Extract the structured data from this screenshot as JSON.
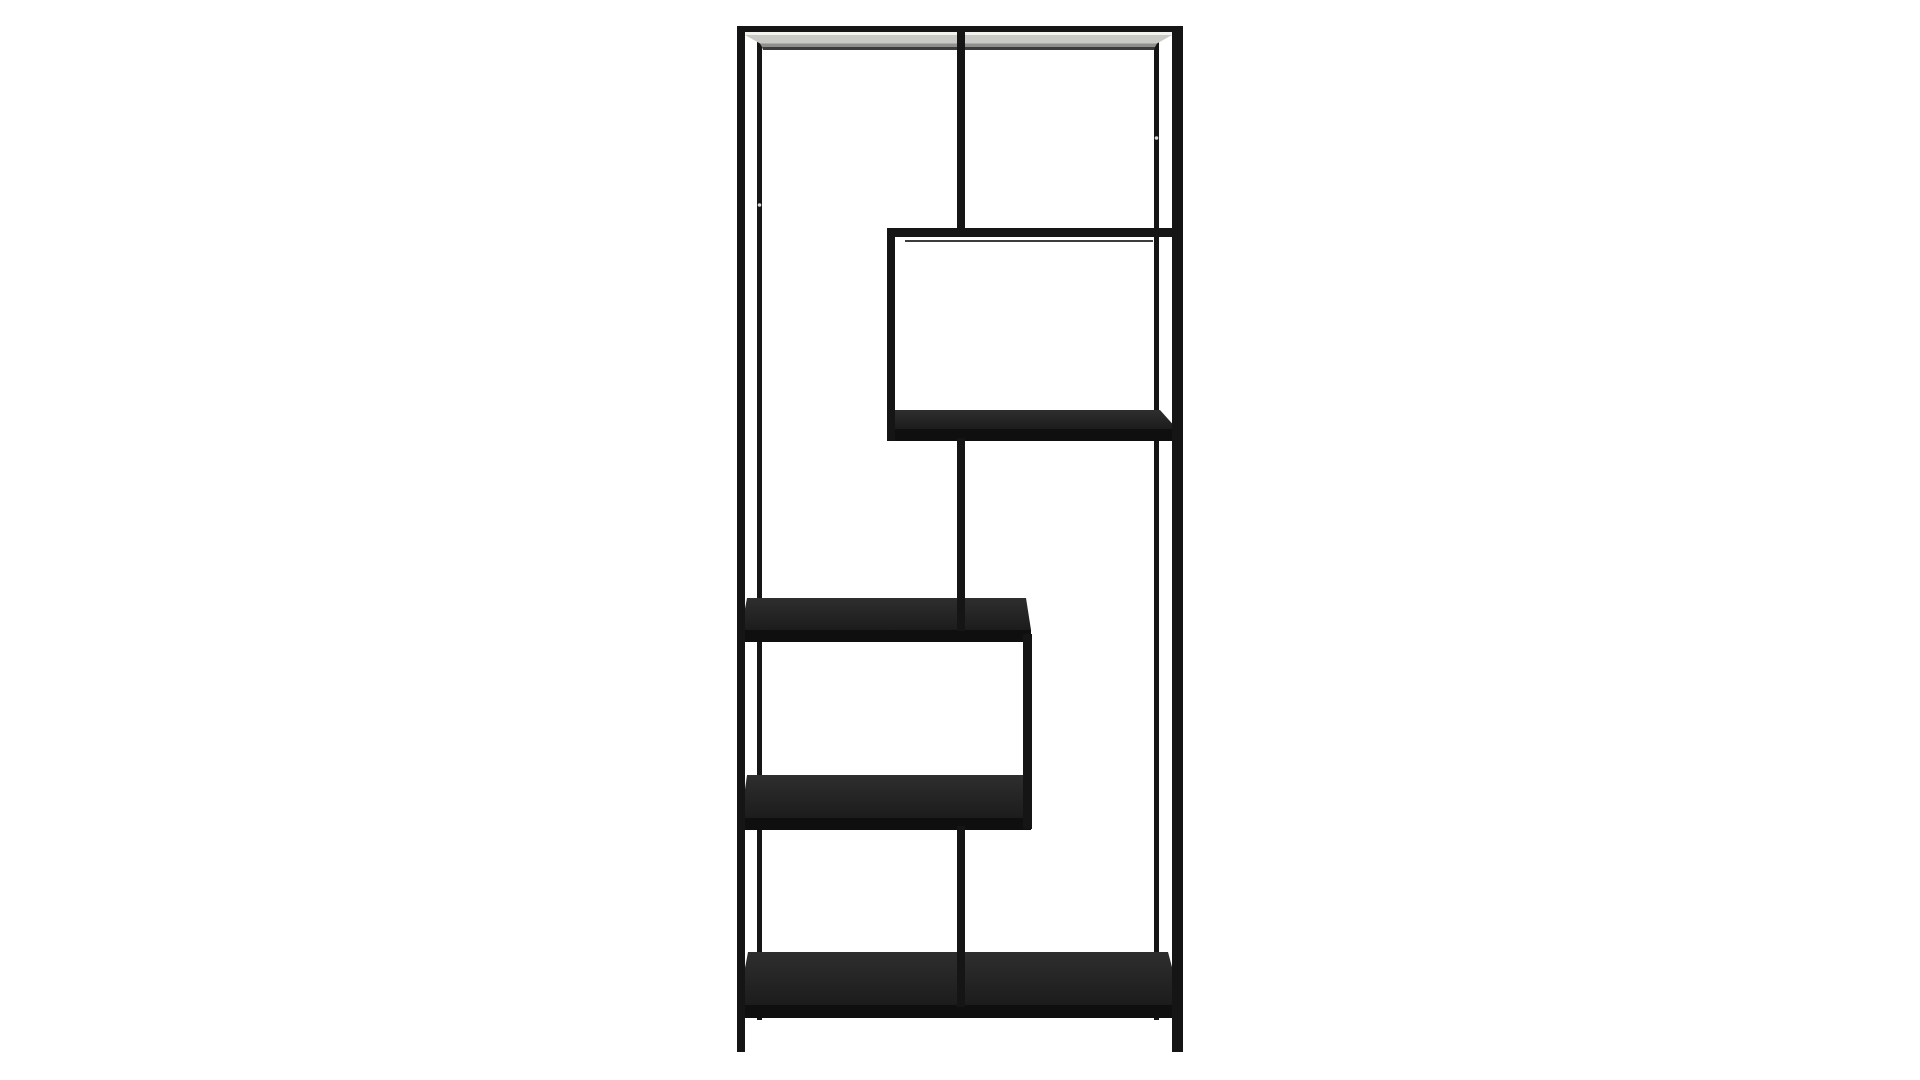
{
  "scene": {
    "type": "product-photo",
    "subject": "asymmetric-black-metal-bookcase",
    "description": "Tall rectangular black metal shelving unit with staggered black wood shelves on a plain white background",
    "background_color": "#ffffff"
  },
  "colors": {
    "metal": "#151515",
    "metal_faint": "#3c3c3c",
    "wood_top": "#1c1c1c",
    "wood_top_light": "#2e2e2e",
    "wood_front": "#0f0f0f",
    "top_shelf_highlight": "#f2f2ef",
    "top_shelf_light": "#c9c9c6",
    "top_shelf_shade": "#8f8f8d",
    "screw_dot": "#d9d9d9",
    "background": "#ffffff"
  },
  "geometry": {
    "viewbox": "0 0 1920 1080",
    "metal_bars": [
      {
        "name": "back-left-leg",
        "layer": "back",
        "x": 757,
        "y": 40,
        "w": 5,
        "h": 980
      },
      {
        "name": "back-right-leg",
        "layer": "back",
        "x": 1154,
        "y": 40,
        "w": 5,
        "h": 980
      },
      {
        "name": "top-rail",
        "layer": "front",
        "x": 737,
        "y": 26,
        "w": 446,
        "h": 6
      },
      {
        "name": "center-divider-upper",
        "layer": "front",
        "x": 957,
        "y": 31,
        "w": 8,
        "h": 201
      },
      {
        "name": "upper-right-shelf-rail",
        "layer": "front",
        "x": 887,
        "y": 228,
        "w": 290,
        "h": 9
      },
      {
        "name": "upper-right-shelf-back-edge",
        "layer": "front",
        "x": 905,
        "y": 240,
        "w": 248,
        "h": 2,
        "color": "metal_faint"
      },
      {
        "name": "upper-box-left-post",
        "layer": "front",
        "x": 887,
        "y": 228,
        "w": 8,
        "h": 213
      },
      {
        "name": "center-divider-middle",
        "layer": "front",
        "x": 957,
        "y": 438,
        "w": 8,
        "h": 193
      },
      {
        "name": "lower-box-right-post",
        "layer": "front",
        "x": 1023,
        "y": 634,
        "w": 9,
        "h": 195
      },
      {
        "name": "center-divider-lower",
        "layer": "front",
        "x": 957,
        "y": 826,
        "w": 8,
        "h": 181
      },
      {
        "name": "front-left-leg",
        "layer": "front",
        "x": 737,
        "y": 26,
        "w": 8,
        "h": 1026
      },
      {
        "name": "front-right-leg",
        "layer": "front",
        "x": 1172,
        "y": 26,
        "w": 11,
        "h": 1026
      }
    ],
    "top_shelf_strips": [
      {
        "name": "top-shelf-highlight",
        "points": "745,32 1172,32 1172,35 745,35",
        "color": "top_shelf_highlight"
      },
      {
        "name": "top-shelf-surface",
        "points": "745,35 1172,35 1157,43.5 760,43.5",
        "color": "top_shelf_light"
      },
      {
        "name": "top-shelf-shade",
        "points": "760,43.5 1157,43.5 1155,47 762,47",
        "color": "top_shelf_shade"
      },
      {
        "name": "top-shelf-underline",
        "points": "762,47 1155,47 1154,50 763,50",
        "color": "metal_faint"
      }
    ],
    "wood_shelves": [
      {
        "name": "upper-right-shelf",
        "top_points": "893,410 1160,410 1177,429 887,429",
        "face": {
          "x": 887,
          "y": 429,
          "w": 290,
          "h": 12
        }
      },
      {
        "name": "middle-left-shelf",
        "top_points": "747,598 1026,598 1031,630 741,630",
        "face": {
          "x": 741,
          "y": 630,
          "w": 290,
          "h": 12
        }
      },
      {
        "name": "lower-left-shelf",
        "top_points": "747,775 1026,775 1031,818 741,818",
        "face": {
          "x": 741,
          "y": 818,
          "w": 290,
          "h": 12
        }
      },
      {
        "name": "bottom-shelf",
        "top_points": "748,952 1168,952 1182,1005 738,1005",
        "face": {
          "x": 738,
          "y": 1005,
          "w": 444,
          "h": 13
        }
      }
    ],
    "screw_dots": [
      {
        "name": "screw-hole-left-leg",
        "cx": 759.5,
        "cy": 205,
        "r": 1.8
      },
      {
        "name": "screw-hole-right-leg",
        "cx": 1156.5,
        "cy": 138,
        "r": 1.8
      }
    ]
  }
}
